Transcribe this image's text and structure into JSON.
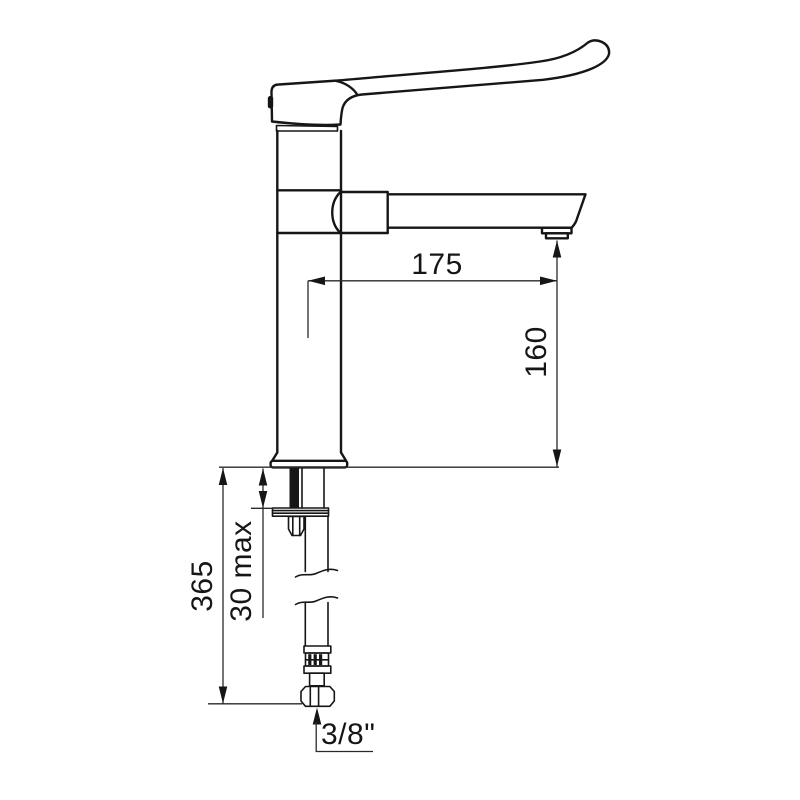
{
  "page": {
    "background_color": "#ffffff",
    "line_color": "#161616"
  },
  "drawing": {
    "labels": {
      "spout_reach": "175",
      "spout_height": "160",
      "below_deck_length": "365",
      "deck_thickness": "30 max",
      "connection_size": "3/8\""
    }
  }
}
